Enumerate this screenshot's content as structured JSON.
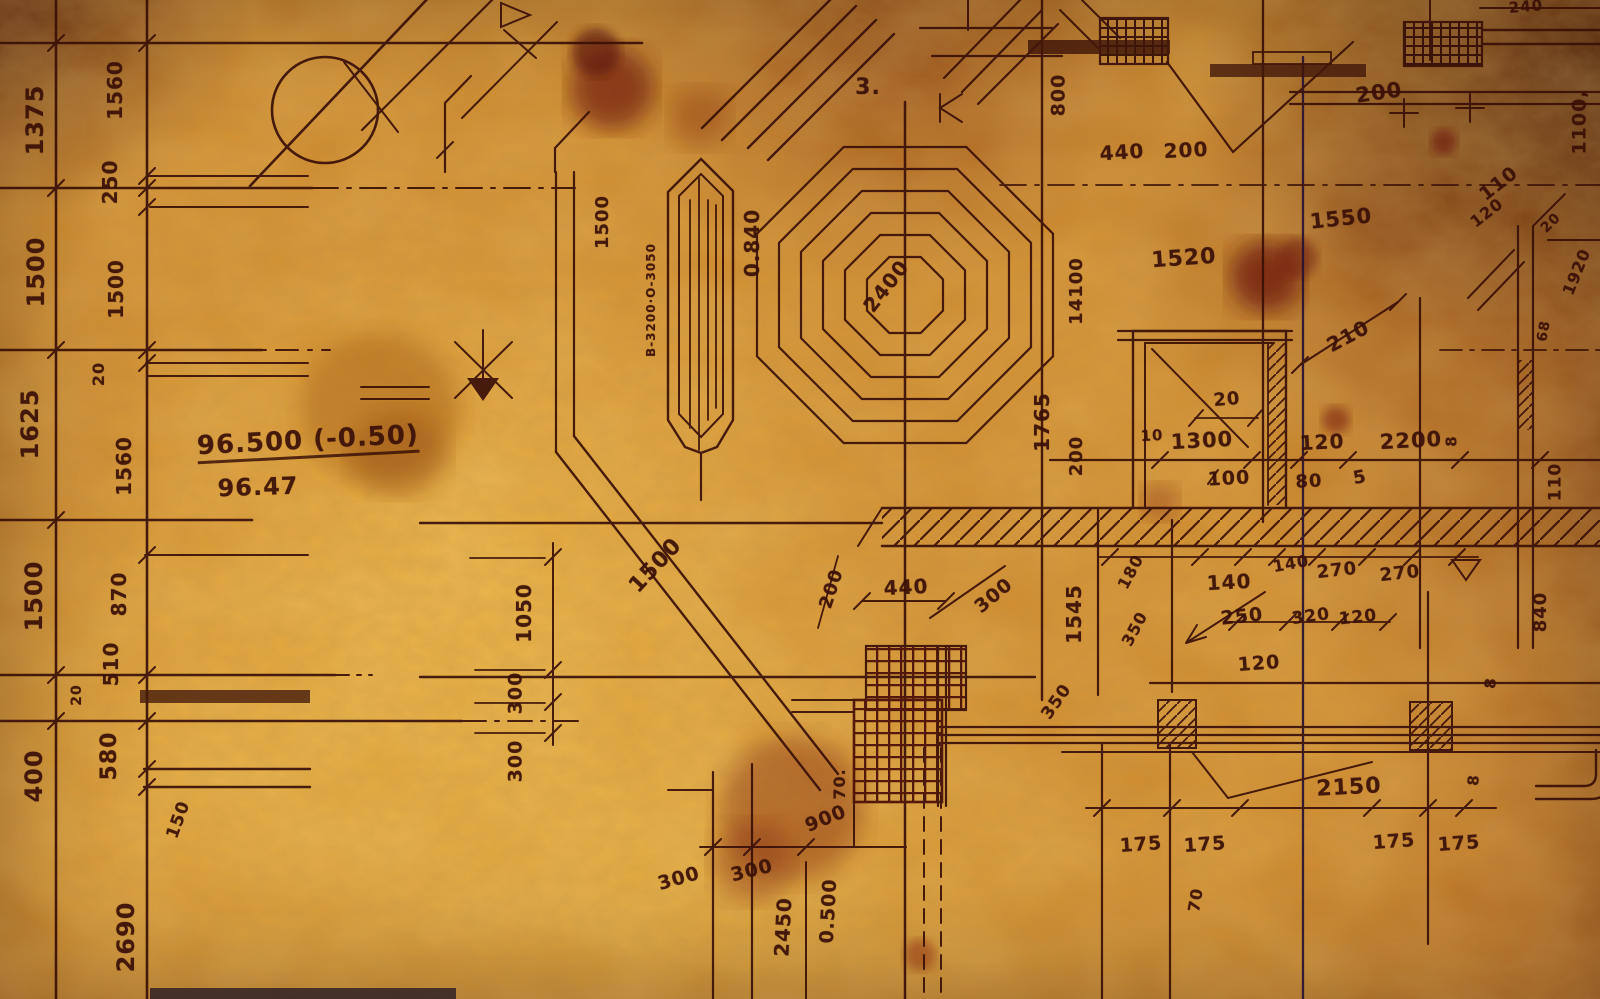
{
  "document": {
    "kind": "hand-drawn construction blueprint, aged stained paper",
    "elevation_note_top": "96.500 (-0.50)",
    "elevation_note_bottom": "96.47"
  },
  "drawing": {
    "ink_color": "#3a1007",
    "ink_dark": "#2c0d10",
    "ink_red": "#4a0e06",
    "paper_bright": "#f2bc49",
    "paper_mid": "#d08a2b",
    "paper_dark": "#5e2108",
    "stain_color": "#6f1d0c"
  },
  "labels": [
    {
      "t": "1375",
      "x": 35,
      "y": 120,
      "r": -90,
      "s": 24
    },
    {
      "t": "1500",
      "x": 36,
      "y": 272,
      "r": -90,
      "s": 24
    },
    {
      "t": "1625",
      "x": 30,
      "y": 424,
      "r": -90,
      "s": 24
    },
    {
      "t": "1500",
      "x": 34,
      "y": 596,
      "r": -90,
      "s": 24
    },
    {
      "t": "400",
      "x": 34,
      "y": 776,
      "r": -90,
      "s": 24
    },
    {
      "t": "2690",
      "x": 126,
      "y": 937,
      "r": -90,
      "s": 24
    },
    {
      "t": "1560",
      "x": 115,
      "y": 90,
      "r": -90,
      "s": 20
    },
    {
      "t": "250",
      "x": 110,
      "y": 182,
      "r": -90,
      "s": 20
    },
    {
      "t": "1500",
      "x": 116,
      "y": 289,
      "r": -90,
      "s": 20
    },
    {
      "t": "20",
      "x": 99,
      "y": 374,
      "r": -90,
      "s": 16
    },
    {
      "t": "1560",
      "x": 124,
      "y": 466,
      "r": -90,
      "s": 20
    },
    {
      "t": "870",
      "x": 119,
      "y": 594,
      "r": -90,
      "s": 20
    },
    {
      "t": "510",
      "x": 111,
      "y": 664,
      "r": -90,
      "s": 20
    },
    {
      "t": "20",
      "x": 77,
      "y": 695,
      "r": -90,
      "s": 14
    },
    {
      "t": "580",
      "x": 110,
      "y": 756,
      "r": -90,
      "s": 22
    },
    {
      "t": "150",
      "x": 179,
      "y": 820,
      "r": -70,
      "s": 17
    },
    {
      "t": "96.500 (-0.50)",
      "x": 308,
      "y": 443,
      "r": -3,
      "s": 26,
      "u": 1
    },
    {
      "t": "96.47",
      "x": 258,
      "y": 487,
      "r": -2,
      "s": 24
    },
    {
      "t": "1050",
      "x": 524,
      "y": 613,
      "r": -90,
      "s": 20
    },
    {
      "t": "300",
      "x": 516,
      "y": 693,
      "r": -90,
      "s": 19
    },
    {
      "t": "300",
      "x": 516,
      "y": 761,
      "r": -90,
      "s": 19
    },
    {
      "t": "1500",
      "x": 656,
      "y": 566,
      "r": -47,
      "s": 22
    },
    {
      "t": "1500",
      "x": 603,
      "y": 222,
      "r": -90,
      "s": 18
    },
    {
      "t": "B-3200·O-3050",
      "x": 651,
      "y": 300,
      "r": -90,
      "s": 12
    },
    {
      "t": "0.840",
      "x": 752,
      "y": 243,
      "r": -90,
      "s": 20
    },
    {
      "t": "2400",
      "x": 886,
      "y": 286,
      "r": -52,
      "s": 20
    },
    {
      "t": "3.",
      "x": 868,
      "y": 88,
      "r": 0,
      "s": 22
    },
    {
      "t": "800",
      "x": 1059,
      "y": 95,
      "r": -90,
      "s": 19
    },
    {
      "t": "440",
      "x": 1122,
      "y": 152,
      "r": -4,
      "s": 20
    },
    {
      "t": "200",
      "x": 1186,
      "y": 150,
      "r": -3,
      "s": 20
    },
    {
      "t": "200",
      "x": 1379,
      "y": 93,
      "r": -8,
      "s": 21
    },
    {
      "t": "240",
      "x": 1526,
      "y": 7,
      "r": -5,
      "s": 15
    },
    {
      "t": "1100,",
      "x": 1580,
      "y": 122,
      "r": -90,
      "s": 19
    },
    {
      "t": "1550",
      "x": 1341,
      "y": 219,
      "r": -6,
      "s": 21
    },
    {
      "t": "1520",
      "x": 1184,
      "y": 259,
      "r": -4,
      "s": 22
    },
    {
      "t": "110",
      "x": 1499,
      "y": 184,
      "r": -38,
      "s": 19
    },
    {
      "t": "120",
      "x": 1487,
      "y": 213,
      "r": -38,
      "s": 16
    },
    {
      "t": "20",
      "x": 1551,
      "y": 223,
      "r": -45,
      "s": 14
    },
    {
      "t": "1920",
      "x": 1577,
      "y": 272,
      "r": -68,
      "s": 16
    },
    {
      "t": "210",
      "x": 1348,
      "y": 336,
      "r": -28,
      "s": 20
    },
    {
      "t": "14100",
      "x": 1077,
      "y": 291,
      "r": -90,
      "s": 18
    },
    {
      "t": "1765",
      "x": 1042,
      "y": 422,
      "r": -90,
      "s": 20
    },
    {
      "t": "200",
      "x": 1077,
      "y": 456,
      "r": -90,
      "s": 18
    },
    {
      "t": "20",
      "x": 1227,
      "y": 400,
      "r": -5,
      "s": 18
    },
    {
      "t": "10",
      "x": 1152,
      "y": 436,
      "r": -3,
      "s": 15
    },
    {
      "t": "1300",
      "x": 1202,
      "y": 441,
      "r": -3,
      "s": 21
    },
    {
      "t": "120",
      "x": 1322,
      "y": 442,
      "r": -3,
      "s": 20
    },
    {
      "t": "2200",
      "x": 1411,
      "y": 441,
      "r": -3,
      "s": 21
    },
    {
      "t": "100",
      "x": 1229,
      "y": 479,
      "r": -3,
      "s": 19
    },
    {
      "t": "80",
      "x": 1309,
      "y": 482,
      "r": -3,
      "s": 18
    },
    {
      "t": "5",
      "x": 1360,
      "y": 478,
      "r": -10,
      "s": 18
    },
    {
      "t": "110",
      "x": 1556,
      "y": 482,
      "r": -90,
      "s": 17
    },
    {
      "t": "8",
      "x": 1452,
      "y": 441,
      "r": -90,
      "s": 15
    },
    {
      "t": "68",
      "x": 1544,
      "y": 331,
      "r": -80,
      "s": 14
    },
    {
      "t": "1545",
      "x": 1074,
      "y": 614,
      "r": -90,
      "s": 20
    },
    {
      "t": "180",
      "x": 1131,
      "y": 572,
      "r": -62,
      "s": 16
    },
    {
      "t": "350",
      "x": 1135,
      "y": 629,
      "r": -62,
      "s": 16
    },
    {
      "t": "140",
      "x": 1229,
      "y": 582,
      "r": -3,
      "s": 20
    },
    {
      "t": "140",
      "x": 1291,
      "y": 564,
      "r": -10,
      "s": 16
    },
    {
      "t": "270",
      "x": 1337,
      "y": 571,
      "r": -6,
      "s": 18
    },
    {
      "t": "270",
      "x": 1400,
      "y": 574,
      "r": -6,
      "s": 18
    },
    {
      "t": "250",
      "x": 1242,
      "y": 617,
      "r": -6,
      "s": 19
    },
    {
      "t": "320",
      "x": 1311,
      "y": 617,
      "r": -8,
      "s": 17
    },
    {
      "t": "120",
      "x": 1358,
      "y": 618,
      "r": -6,
      "s": 17
    },
    {
      "t": "120",
      "x": 1259,
      "y": 664,
      "r": -4,
      "s": 19
    },
    {
      "t": "840",
      "x": 1541,
      "y": 612,
      "r": -90,
      "s": 18
    },
    {
      "t": "200",
      "x": 832,
      "y": 589,
      "r": -72,
      "s": 18
    },
    {
      "t": "440",
      "x": 906,
      "y": 587,
      "r": -3,
      "s": 20
    },
    {
      "t": "300",
      "x": 994,
      "y": 596,
      "r": -40,
      "s": 19
    },
    {
      "t": "350",
      "x": 1057,
      "y": 702,
      "r": -55,
      "s": 17
    },
    {
      "t": "70.",
      "x": 840,
      "y": 784,
      "r": -90,
      "s": 16
    },
    {
      "t": "900",
      "x": 826,
      "y": 819,
      "r": -22,
      "s": 19
    },
    {
      "t": "300",
      "x": 679,
      "y": 879,
      "r": -16,
      "s": 19
    },
    {
      "t": "300",
      "x": 752,
      "y": 871,
      "r": -14,
      "s": 19
    },
    {
      "t": "2450",
      "x": 783,
      "y": 927,
      "r": -87,
      "s": 20
    },
    {
      "t": "0.500",
      "x": 829,
      "y": 911,
      "r": -87,
      "s": 19
    },
    {
      "t": "2150",
      "x": 1349,
      "y": 788,
      "r": -3,
      "s": 22
    },
    {
      "t": "175",
      "x": 1141,
      "y": 845,
      "r": -4,
      "s": 19
    },
    {
      "t": "175",
      "x": 1205,
      "y": 845,
      "r": -4,
      "s": 19
    },
    {
      "t": "175",
      "x": 1394,
      "y": 842,
      "r": -4,
      "s": 19
    },
    {
      "t": "175",
      "x": 1459,
      "y": 844,
      "r": -4,
      "s": 19
    },
    {
      "t": "70",
      "x": 1196,
      "y": 900,
      "r": -80,
      "s": 16
    },
    {
      "t": "8",
      "x": 1474,
      "y": 780,
      "r": -85,
      "s": 15
    },
    {
      "t": "8",
      "x": 1491,
      "y": 683,
      "r": -85,
      "s": 15
    }
  ]
}
